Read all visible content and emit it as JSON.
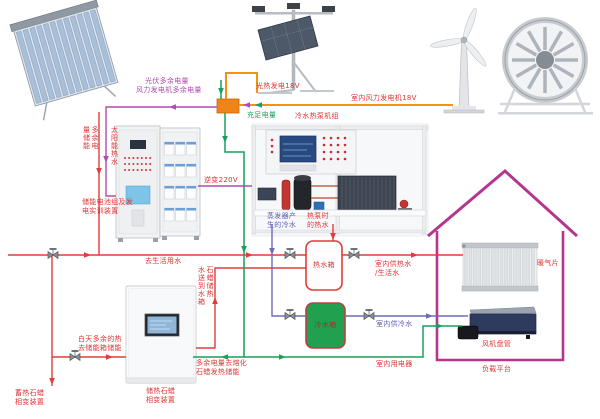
{
  "labels": {
    "solar_hot_water": "太阳能热水",
    "pv_surplus": "光伏多余电量",
    "wind_surplus": "风力发电机多余电量",
    "pv_generation": "光热发电18V",
    "indoor_wind_generation": "室内风力发电机18V",
    "sufficient_power": "充足电量",
    "surplus_storage": "多余电\n量储能",
    "chiller_unit": "冷水热泵机组",
    "battery_cabinet": "储能电池组及发\n电实训装置",
    "inverter": "逆变220V",
    "evaporator_cold_water": "蒸发器产\n生的冷水",
    "heat_pump_hot_water": "热泵时\n的热水",
    "to_domestic_water": "去生活用水",
    "hot_water_tank": "热水箱",
    "indoor_hot_water": "室内供热水\n/生活水",
    "cold_water_tank": "冷水箱",
    "indoor_cold_water": "室内供冷水",
    "day_surplus_heat": "白天多余的热\n去储能箱储能",
    "paraffin_to_tank": "石蜡储热\n水送到水箱",
    "surplus_to_paraffin": "多余电量去熔化\n石蜡发热储能",
    "paraffin_device": "储热石蜡\n相变装置",
    "paraffin_device_bottom": "蓄热石蜡\n相变装置",
    "indoor_appliances": "室内用电器",
    "radiator": "暖气片",
    "fan_coil": "风机盘管",
    "load_platform": "负载平台"
  },
  "colors": {
    "hot_water_line": "#e23b3b",
    "cold_water_line": "#6b6bb8",
    "electric_sufficient_line": "#17a05a",
    "electric_18v_line": "#f5920f",
    "electric_surplus_line": "#b44ab0",
    "house_outline": "#b5368d",
    "cold_tank_fill": "#21a14f",
    "junction_box_fill": "#ef8418"
  }
}
